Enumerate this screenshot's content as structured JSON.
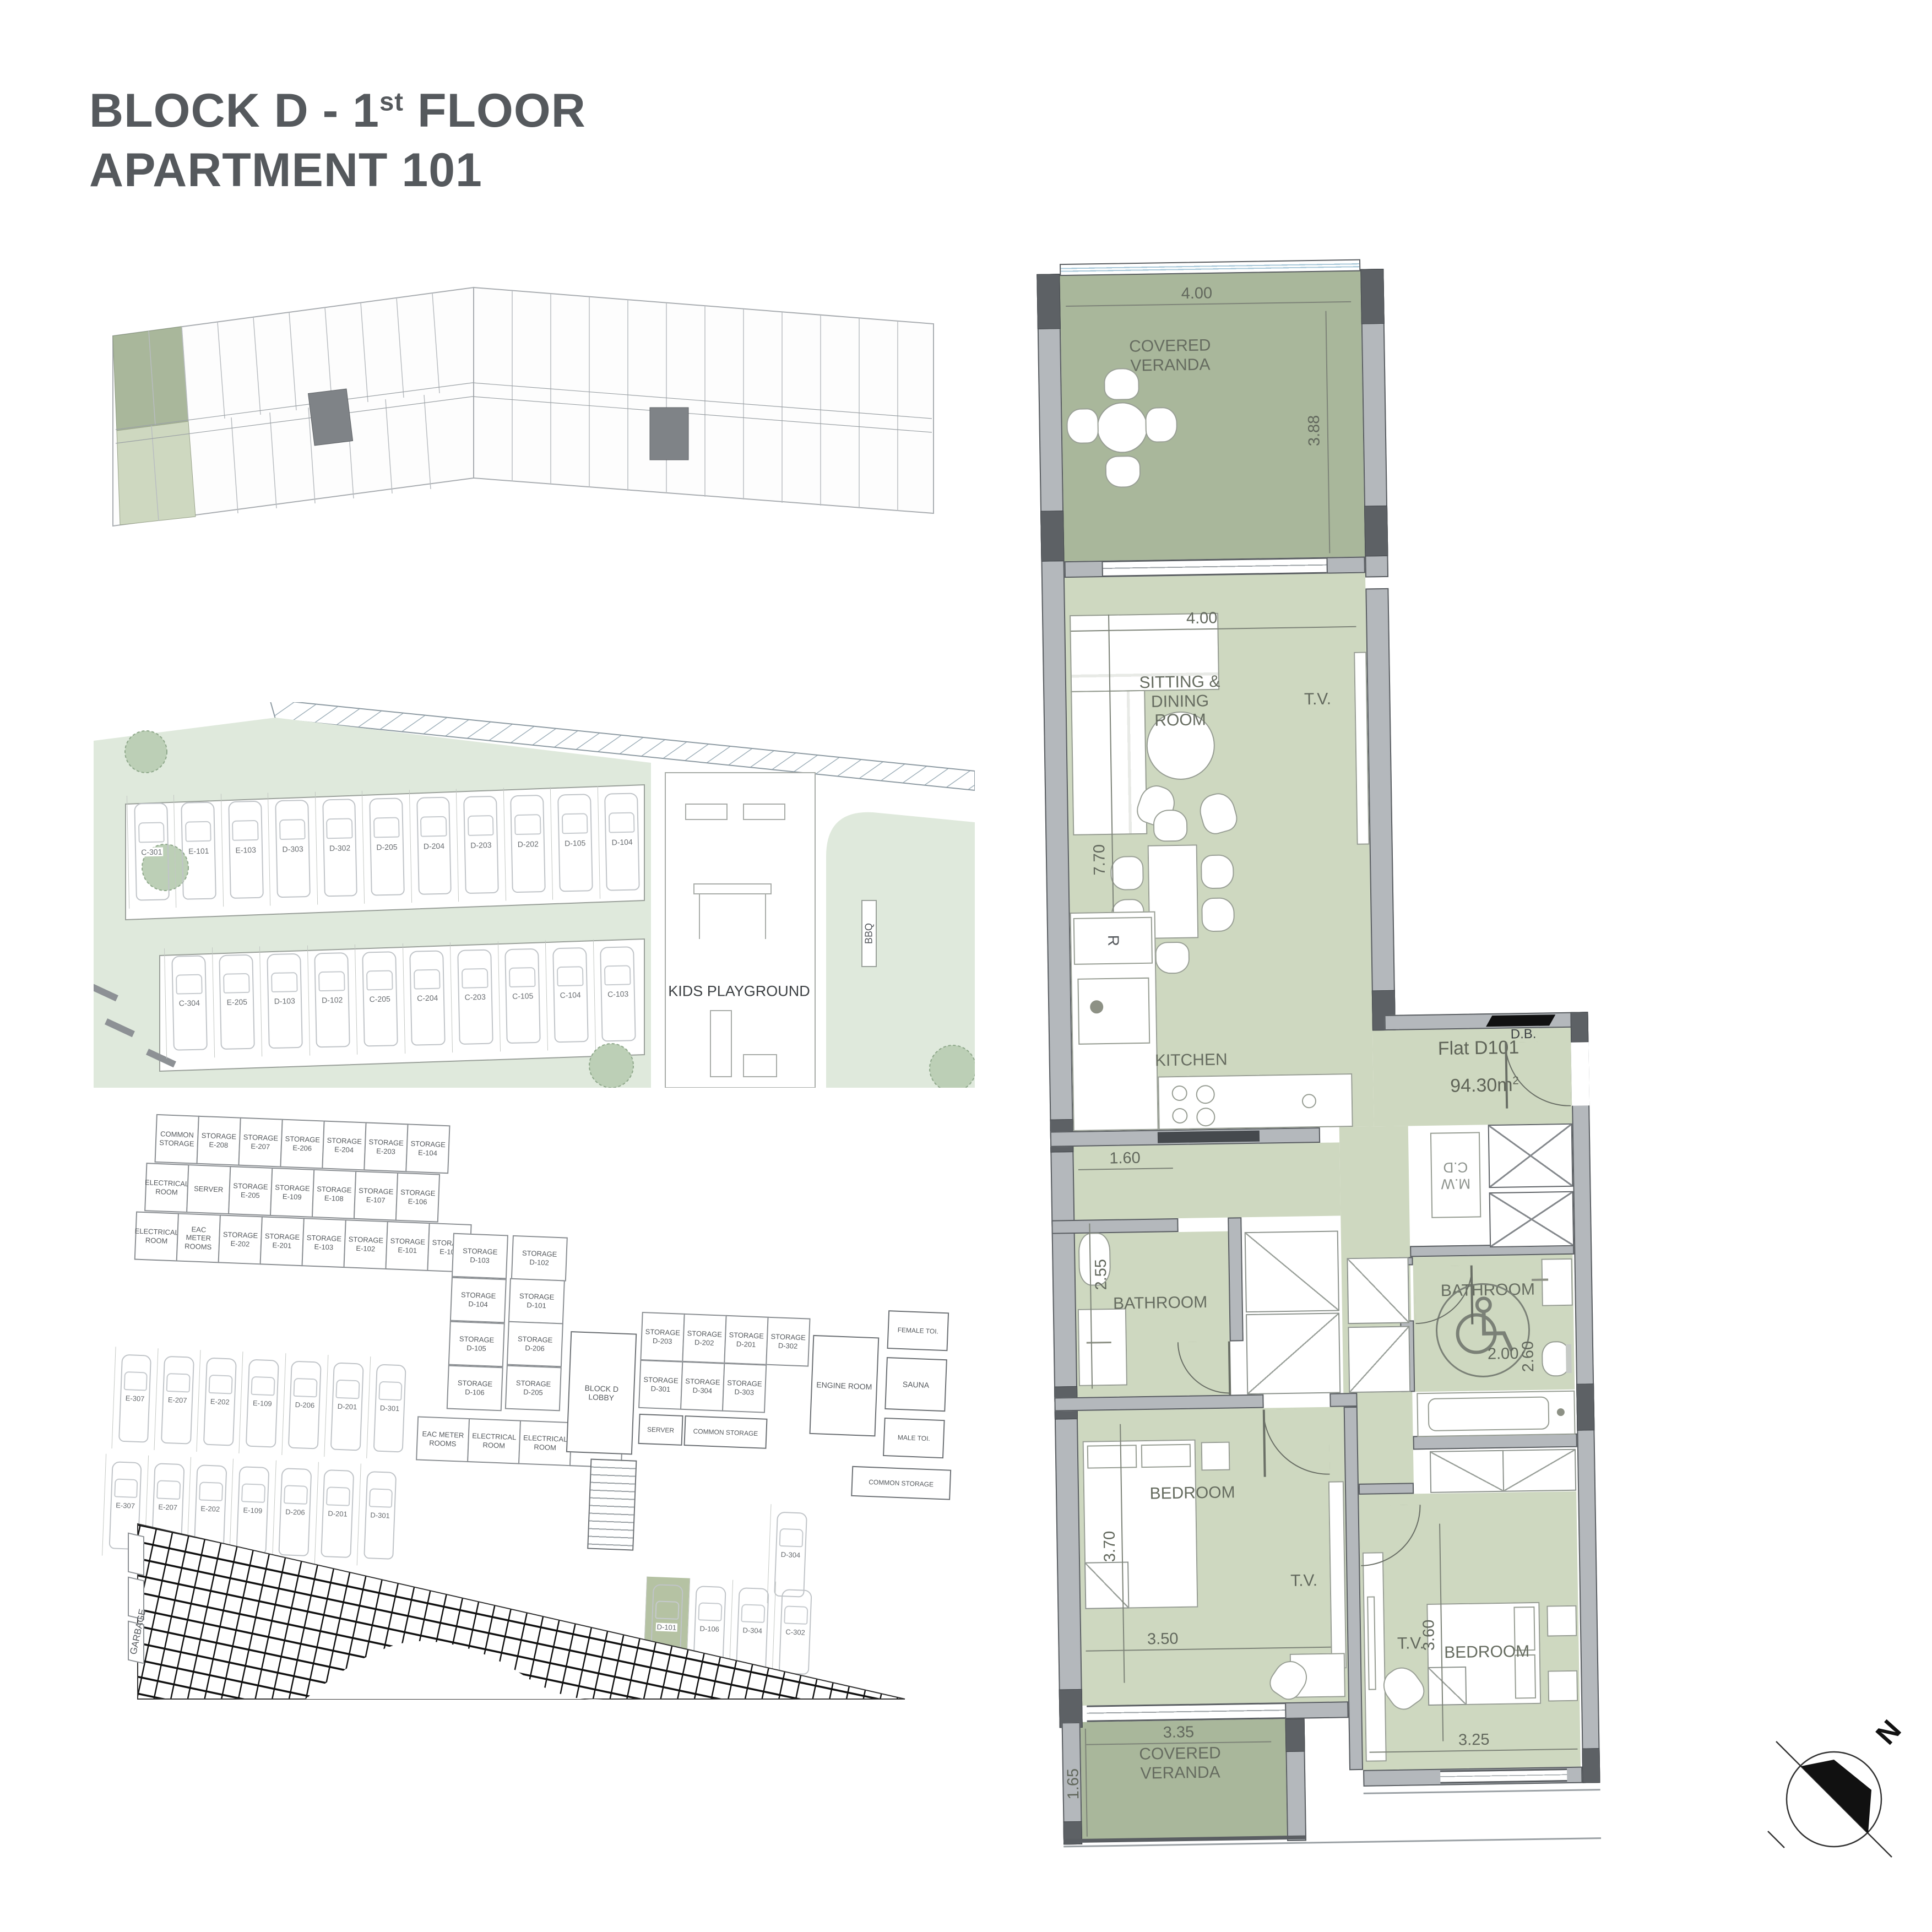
{
  "title": {
    "line1_pre": "BLOCK D - 1",
    "line1_sup": "st",
    "line1_post": " FLOOR",
    "line2": "APARTMENT 101"
  },
  "plan": {
    "veranda_top": {
      "label": "COVERED\nVERANDA",
      "dim_w": "4.00",
      "dim_h": "3.88"
    },
    "living": {
      "label": "SITTING &\nDINING\nROOM",
      "tv": "T.V.",
      "dim_w": "4.00",
      "dim_h": "7.70"
    },
    "kitchen": {
      "label": "KITCHEN",
      "fridge": "R",
      "dim_hall": "1.60"
    },
    "entry": {
      "flat": "Flat D101",
      "area_value": "94.30m",
      "area_sup": "2",
      "db": "D.B."
    },
    "utility": {
      "wm": "M.W\nC.D"
    },
    "bath1": {
      "label": "BATHROOM",
      "dim_h": "2.55"
    },
    "bath2": {
      "label": "BATHROOM",
      "dim_w": "2.00",
      "dim_h": "2.60"
    },
    "bed1": {
      "label": "BEDROOM",
      "dim_h": "3.70",
      "dim_w": "3.50",
      "tv": "T.V."
    },
    "bed2": {
      "label": "BEDROOM",
      "dim_h": "3.60",
      "dim_w": "3.25",
      "tv": "T.V."
    },
    "veranda_bottom": {
      "label": "COVERED\nVERANDA",
      "dim_w": "3.35",
      "dim_h": "1.65"
    }
  },
  "site": {
    "kids_playground": "KIDS PLAYGROUND",
    "bbq": "BBQ",
    "parking_top": [
      "C-301",
      "E-101",
      "E-103",
      "D-303",
      "D-302",
      "D-205",
      "D-204",
      "D-203",
      "D-202",
      "D-105",
      "D-104"
    ],
    "parking_bottom": [
      "C-304",
      "E-205",
      "D-103",
      "D-102",
      "C-205",
      "C-204",
      "C-203",
      "C-105",
      "C-104",
      "C-103"
    ]
  },
  "basement": {
    "storage_row1": [
      "COMMON\nSTORAGE",
      "STORAGE\nE-208",
      "STORAGE\nE-207",
      "STORAGE\nE-206",
      "STORAGE\nE-204",
      "STORAGE\nE-203",
      "STORAGE\nE-104"
    ],
    "storage_row2": [
      "ELECTRICAL\nROOM",
      "SERVER",
      "STORAGE\nE-205",
      "STORAGE\nE-109",
      "STORAGE\nE-108",
      "STORAGE\nE-107",
      "STORAGE\nE-106"
    ],
    "storage_row3": [
      "ELECTRICAL\nROOM",
      "EAC METER\nROOMS",
      "STORAGE\nE-202",
      "STORAGE\nE-201",
      "STORAGE\nE-103",
      "STORAGE\nE-102",
      "STORAGE\nE-101",
      "STORAGE\nE-105"
    ],
    "storage_mid_left": [
      "STORAGE\nD-103",
      "STORAGE\nD-104",
      "STORAGE\nD-105",
      "STORAGE\nD-106"
    ],
    "storage_mid_right_top": "STORAGE\nD-102",
    "storage_mid_highlight": "STORAGE\nD-101",
    "storage_mid_right_rest": [
      "STORAGE\nD-206",
      "STORAGE\nD-205"
    ],
    "storage_mid_bottom": [
      "EAC METER\nROOMS",
      "ELECTRICAL\nROOM",
      "ELECTRICAL\nROOM",
      "STORAGE\nD-204"
    ],
    "storage_right_row1": [
      "STORAGE\nD-203",
      "STORAGE\nD-202",
      "STORAGE\nD-201",
      "STORAGE\nD-302"
    ],
    "storage_right_row2": [
      "STORAGE\nD-301",
      "STORAGE\nD-304",
      "STORAGE\nD-303"
    ],
    "lobby": "BLOCK D\nLOBBY",
    "engine": "ENGINE ROOM",
    "sauna": "SAUNA",
    "female_toilet": "FEMALE TOI.",
    "male_toilet": "MALE TOI.",
    "common_storage": "COMMON STORAGE",
    "server": "SERVER",
    "parking_row1": [
      "E-307",
      "E-207",
      "E-202",
      "E-109",
      "D-206",
      "D-201",
      "D-301"
    ],
    "parking_row2": [
      "E-307",
      "E-207",
      "E-202",
      "E-109",
      "D-206",
      "D-201",
      "D-301"
    ],
    "parking_right_top": "D-304",
    "parking_right_highlight": "D-101",
    "parking_right": [
      "D-106",
      "D-304",
      "C-302"
    ],
    "garbage": "GARBAGE"
  },
  "compass": {
    "north": "N"
  }
}
